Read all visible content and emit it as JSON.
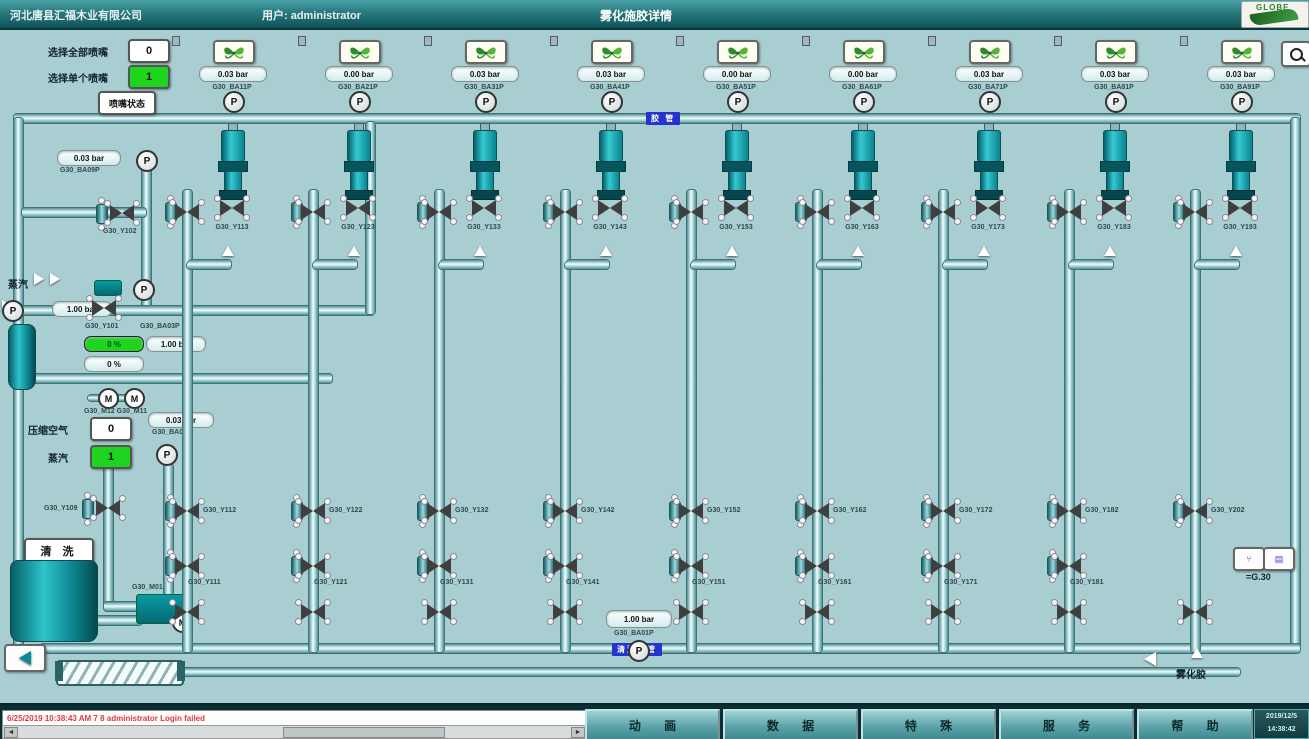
{
  "header": {
    "company": "河北唐县汇福木业有限公司",
    "user": "用户: administrator",
    "title": "雾化施胶详情",
    "logo": "GLOBE"
  },
  "controls": {
    "select_all_label": "选择全部喷嘴",
    "select_all_value": "0",
    "select_single_label": "选择单个喷嘴",
    "select_single_value": "1",
    "nozzle_status_label": "喷嘴状态"
  },
  "pipes": {
    "top_pipe_label": "胶 管",
    "bottom_pipe_label": "清洗水管"
  },
  "nozzles": [
    {
      "pressure": "0.03 bar",
      "tag": "G30_BA11P",
      "valve": "G30_Y113",
      "lower_top": "G30_Y112",
      "lower_bottom": "G30_Y111"
    },
    {
      "pressure": "0.00 bar",
      "tag": "G30_BA21P",
      "valve": "G30_Y123",
      "lower_top": "G30_Y122",
      "lower_bottom": "G30_Y121"
    },
    {
      "pressure": "0.03 bar",
      "tag": "G30_BA31P",
      "valve": "G30_Y133",
      "lower_top": "G30_Y132",
      "lower_bottom": "G30_Y131"
    },
    {
      "pressure": "0.03 bar",
      "tag": "G30_BA41P",
      "valve": "G30_Y143",
      "lower_top": "G30_Y142",
      "lower_bottom": "G30_Y141"
    },
    {
      "pressure": "0.00 bar",
      "tag": "G30_BA51P",
      "valve": "G30_Y153",
      "lower_top": "G30_Y152",
      "lower_bottom": "G30_Y151"
    },
    {
      "pressure": "0.00 bar",
      "tag": "G30_BA61P",
      "valve": "G30_Y163",
      "lower_top": "G30_Y162",
      "lower_bottom": "G30_Y161"
    },
    {
      "pressure": "0.03 bar",
      "tag": "G30_BA71P",
      "valve": "G30_Y173",
      "lower_top": "G30_Y172",
      "lower_bottom": "G30_Y171"
    },
    {
      "pressure": "0.03 bar",
      "tag": "G30_BA81P",
      "valve": "G30_Y183",
      "lower_top": "G30_Y182",
      "lower_bottom": "G30_Y181"
    },
    {
      "pressure": "0.03 bar",
      "tag": "G30_BA91P",
      "valve": "G30_Y193",
      "lower_top": "G30_Y202",
      "lower_bottom": null
    }
  ],
  "left_panel": {
    "top_display": {
      "value": "0.03 bar",
      "tag": "G30_BA09P"
    },
    "valve_102": "G30_Y102",
    "steam_label": "蒸汽",
    "steam_pressure": "1.00 bar",
    "valve_101": "G30_Y101",
    "tag_ba03p": "G30_BA03P",
    "green_pct": "0 %",
    "mid_pressure": "1.00 bar",
    "white_pct": "0 %",
    "motors_tag": "G30_M12 G30_M11",
    "air_label": "压缩空气",
    "air_value": "0",
    "steam2_label": "蒸汽",
    "steam2_value": "1",
    "air_display": {
      "value": "0.03 bar",
      "tag": "G30_BA06P"
    },
    "valve_109": "G30_Y109",
    "clean_button": "清 洗",
    "pump_tag": "G30_M01",
    "bottom_display": {
      "value": "1.00 bar",
      "tag": "G30_BA01P"
    }
  },
  "right_panel": {
    "frame_label": "=G.30",
    "outlet_label": "雾化胶"
  },
  "bottom_bar": {
    "alarm_text": "6/25/2019 10:38:43 AM 7 8    administrator    Login failed",
    "buttons": [
      "动 画",
      "数 据",
      "特 殊",
      "服 务",
      "帮 助"
    ],
    "date": "2019/12/5",
    "time": "14:38:42"
  },
  "colors": {
    "accent_green": "#1fd41f",
    "pipe_teal": "#4f8f94",
    "background": "#a8ced2",
    "blue_label": "#2633cf"
  }
}
